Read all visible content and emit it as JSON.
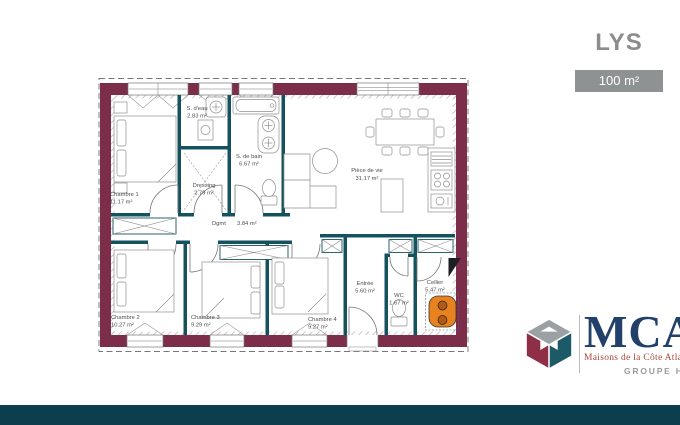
{
  "header": {
    "title": "LYS",
    "area_badge": "100 m²"
  },
  "plan": {
    "rooms": [
      {
        "name": "Chambre 1",
        "area": "11.17 m²"
      },
      {
        "name": "S. d'eau",
        "area": "2.83 m²"
      },
      {
        "name": "Dressing",
        "area": "2.79 m²"
      },
      {
        "name": "S. de bain",
        "area": "6.67 m²"
      },
      {
        "name": "Pièce de vie",
        "area": "31.17 m²"
      },
      {
        "name": "Dgmt",
        "area": "3.84 m²"
      },
      {
        "name": "Chambre 2",
        "area": "10.27 m²"
      },
      {
        "name": "Chambre 3",
        "area": "9.29 m²"
      },
      {
        "name": "Chambre 4",
        "area": "9.27 m²"
      },
      {
        "name": "Entrée",
        "area": "5.60 m²"
      },
      {
        "name": "WC",
        "area": "1.67 m²"
      },
      {
        "name": "Cellier",
        "area": "5.47 m²"
      }
    ],
    "colors": {
      "exterior_wall": "#7b2d49",
      "interior_wall": "#14525e",
      "water_heater": "#e8821e"
    }
  },
  "branding": {
    "logo_text": "MCA",
    "tagline": "Maisons de la Côte Atlantique",
    "group_label": "GROUPE Hexaôm",
    "cube_colors": {
      "gray": "#9aa0a4",
      "teal": "#1c5a68",
      "maroon": "#8e2f47"
    }
  }
}
